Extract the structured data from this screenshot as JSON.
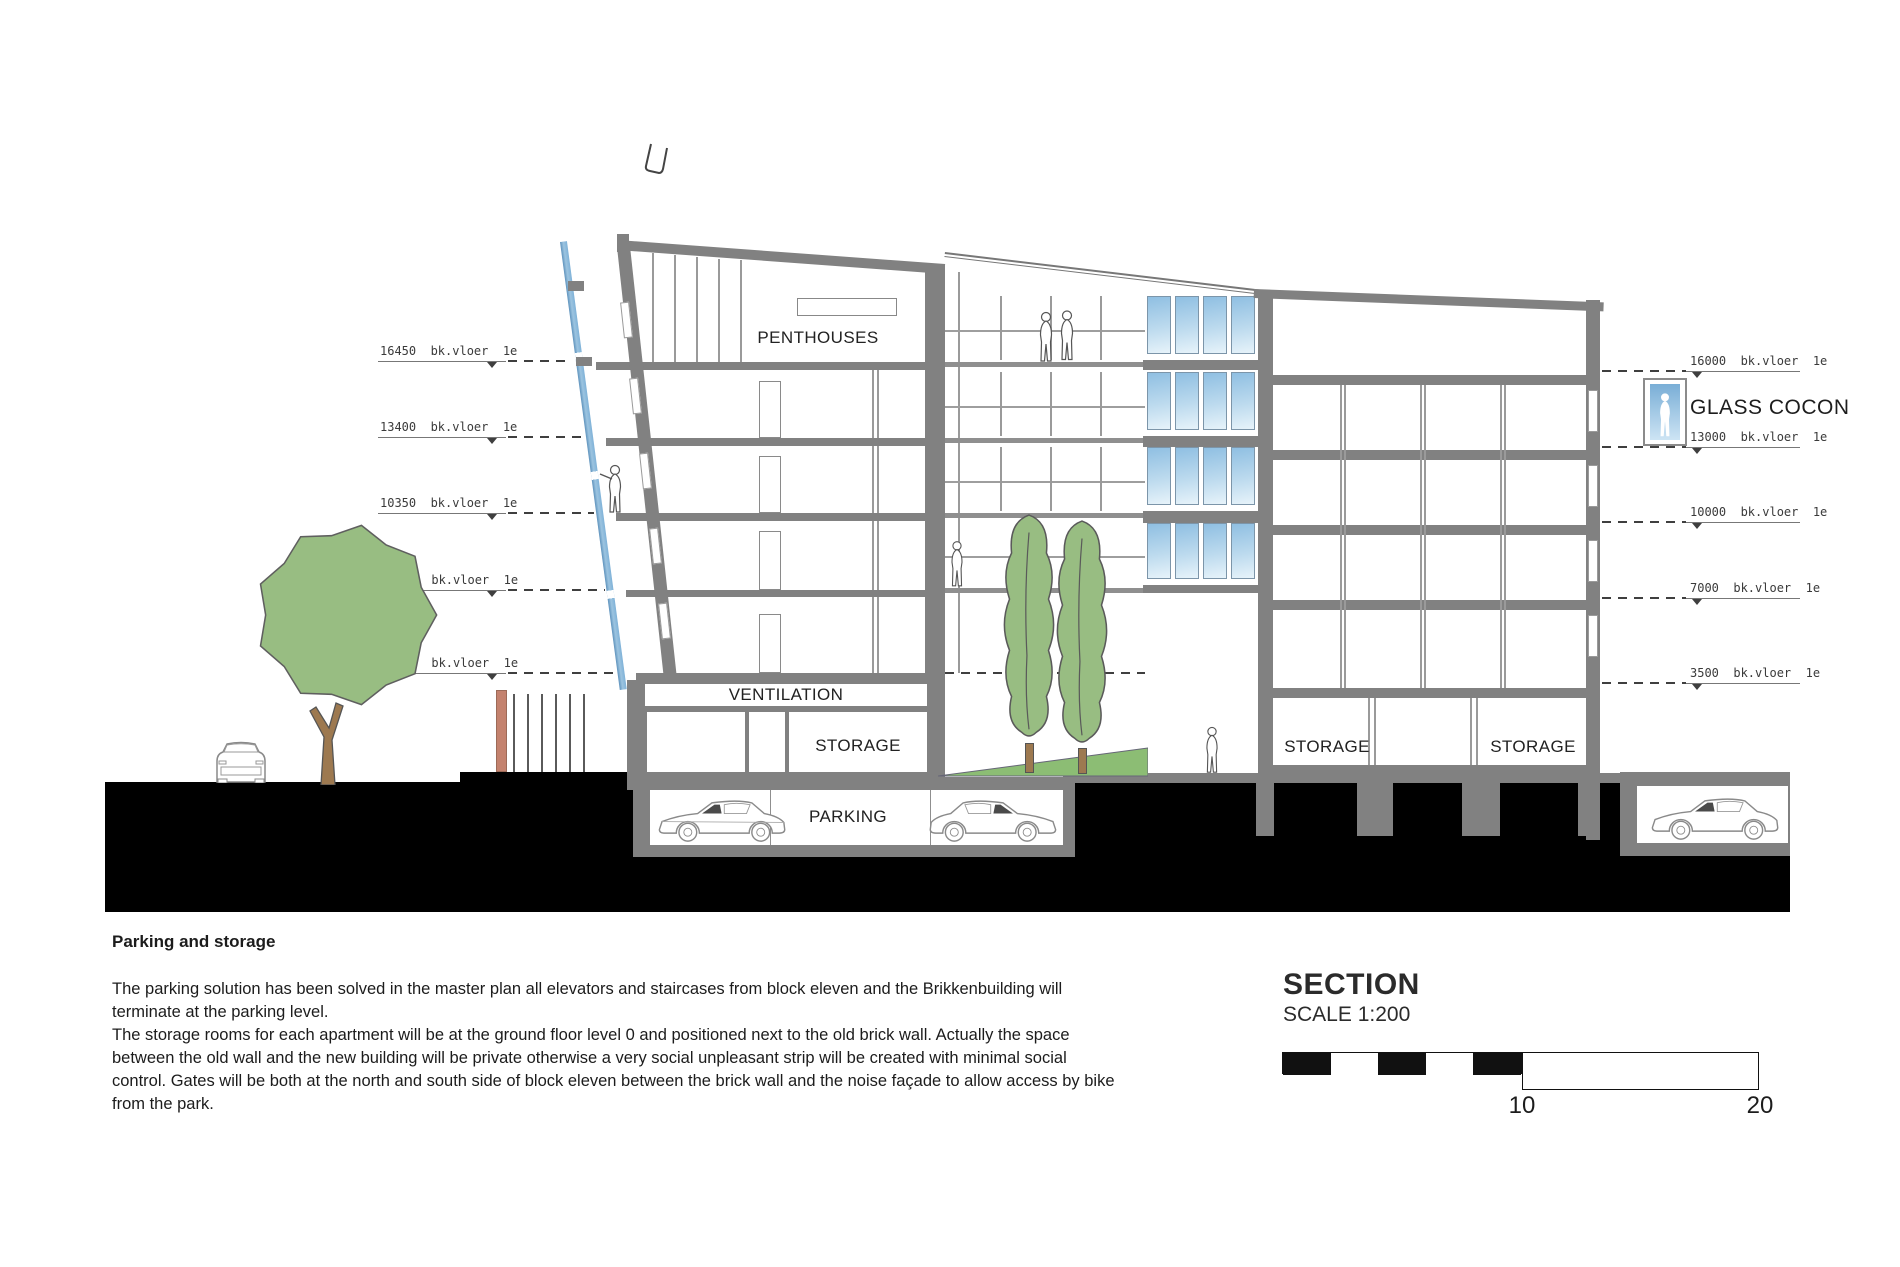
{
  "annotations": {
    "levels_left": [
      {
        "label": "16450  bk.vloer  1e"
      },
      {
        "label": "13400  bk.vloer  1e"
      },
      {
        "label": "10350  bk.vloer  1e"
      },
      {
        "label": "7300  bk.vloer  1e"
      },
      {
        "label": "3950  bk.vloer  1e"
      }
    ],
    "levels_right": [
      {
        "label": "16000  bk.vloer  1e"
      },
      {
        "label": "13000  bk.vloer  1e"
      },
      {
        "label": "10000  bk.vloer  1e"
      },
      {
        "label": "7000  bk.vloer  1e"
      },
      {
        "label": "3500  bk.vloer  1e"
      }
    ],
    "glass_cocon": "GLASS COCON"
  },
  "rooms": {
    "penthouses": "PENTHOUSES",
    "ventilation": "VENTILATION",
    "storage_left": "STORAGE",
    "parking": "PARKING",
    "storage_right_a": "STORAGE",
    "storage_right_b": "STORAGE"
  },
  "title_block": {
    "title": "SECTION",
    "scale": "SCALE 1:200",
    "tick_10": "10",
    "tick_20": "20"
  },
  "notes": {
    "heading": "Parking and storage",
    "body": "The parking solution has been solved in the master plan all elevators and staircases from block eleven and the Brikkenbuilding will\nterminate at the parking level.\nThe storage rooms for each apartment will be at the ground floor level 0 and positioned next to the old brick wall. Actually the space\nbetween the old wall and the new building will be private otherwise a very social unpleasant strip will be created with minimal social\ncontrol. Gates will be both at the north and south side of block eleven between the brick wall and the noise façade to allow access by bike\nfrom the park."
  },
  "colors": {
    "structure_gray": "#818181",
    "ground_black": "#000000",
    "tree_green": "#98bd82",
    "trunk_brown": "#9d7950",
    "glass_blue": "#8fbfe2",
    "brick_wall_red": "#c4826e",
    "noise_facade_blue": "#7fb2d8"
  }
}
